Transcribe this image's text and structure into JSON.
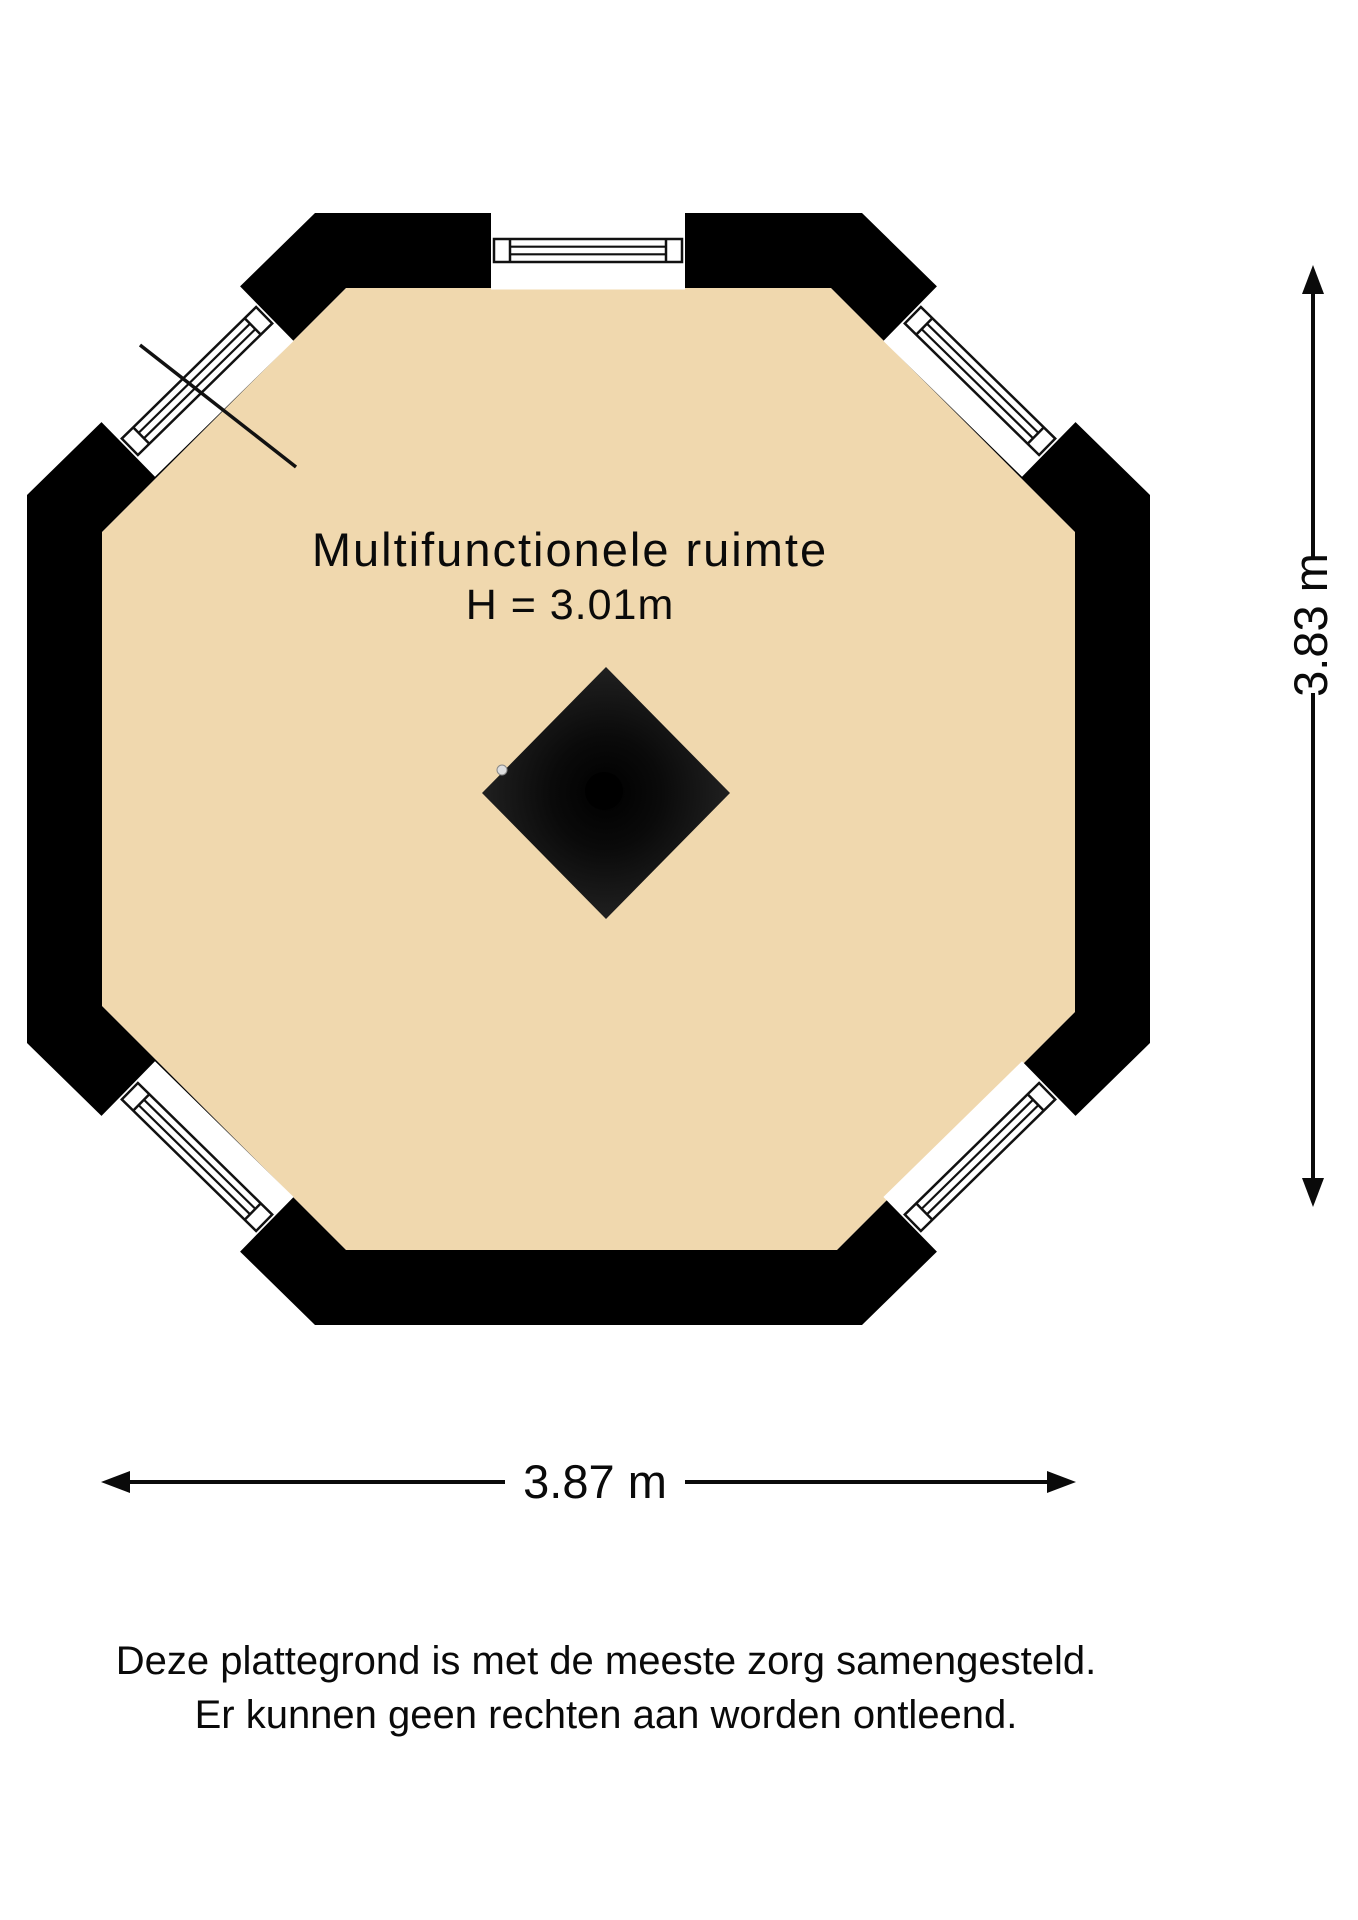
{
  "plan": {
    "room_name": "Multifunctionele ruimte",
    "room_height": "H = 3.01m",
    "shape": "octagon",
    "window_sides": [
      "top",
      "north-west",
      "north-east",
      "south-west",
      "south-east"
    ],
    "solid_sides": [
      "left",
      "right",
      "bottom"
    ],
    "center_feature": "chimney-flue-block"
  },
  "dimensions": {
    "width_label": "3.87 m",
    "height_label": "3.83 m"
  },
  "disclaimer": {
    "line1": "Deze plattegrond is met de meeste zorg samengesteld.",
    "line2": "Er kunnen geen rechten aan worden ontleend."
  },
  "colors": {
    "background": "#FFFFFF",
    "floor": "#F0D8AE",
    "wall": "#000000",
    "line": "#111111",
    "diamond_edge": "#242424",
    "diamond_core": "#000000",
    "dot": "#DEDEDE"
  }
}
